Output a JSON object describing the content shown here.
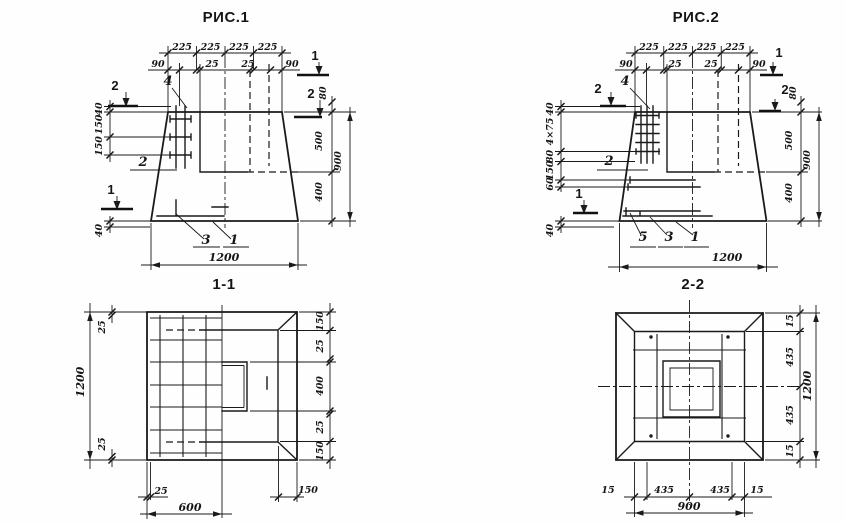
{
  "figure1": {
    "title": "РИС.1",
    "top_dims": [
      "225",
      "225",
      "225",
      "225"
    ],
    "sub_dims": [
      "90",
      "25",
      "25",
      "90"
    ],
    "left_dims": [
      "40",
      "150",
      "150"
    ],
    "left_bottom_dim": "40",
    "right_offset_dim": "80",
    "depth_dims": [
      "500",
      "400"
    ],
    "total_height": "900",
    "total_width": "1200",
    "callouts": {
      "anchor": "4",
      "bars": "2",
      "mesh": "3",
      "slab": "1"
    },
    "markers": {
      "section1": "1",
      "section2": "2"
    }
  },
  "figure2": {
    "title": "РИС.2",
    "top_dims": [
      "225",
      "225",
      "225",
      "225"
    ],
    "sub_dims": [
      "90",
      "25",
      "25",
      "90"
    ],
    "left_dims": [
      "40",
      "4×75",
      "80",
      "150",
      "60"
    ],
    "left_bottom_dim": "40",
    "right_offset_dim": "80",
    "depth_dims": [
      "500",
      "400"
    ],
    "total_height": "900",
    "total_width": "1200",
    "callouts": {
      "anchor": "4",
      "bars": "2",
      "mesh_upper": "5",
      "mesh_lower": "3",
      "slab": "1"
    },
    "markers": {
      "section1": "1",
      "section2": "2"
    }
  },
  "section11": {
    "title": "1-1",
    "side_total": "1200",
    "cover_top": "25",
    "cover_bottom": "25",
    "right_dims": [
      "150",
      "25",
      "400",
      "25",
      "150"
    ],
    "bottom_cover": "25",
    "bottom_half": "600",
    "bottom_edge": "150"
  },
  "section22": {
    "title": "2-2",
    "right_dims": [
      "15",
      "435",
      "435",
      "15"
    ],
    "right_total": "1200",
    "bottom_dims": [
      "15",
      "435",
      "435",
      "15"
    ],
    "bottom_total": "900"
  }
}
